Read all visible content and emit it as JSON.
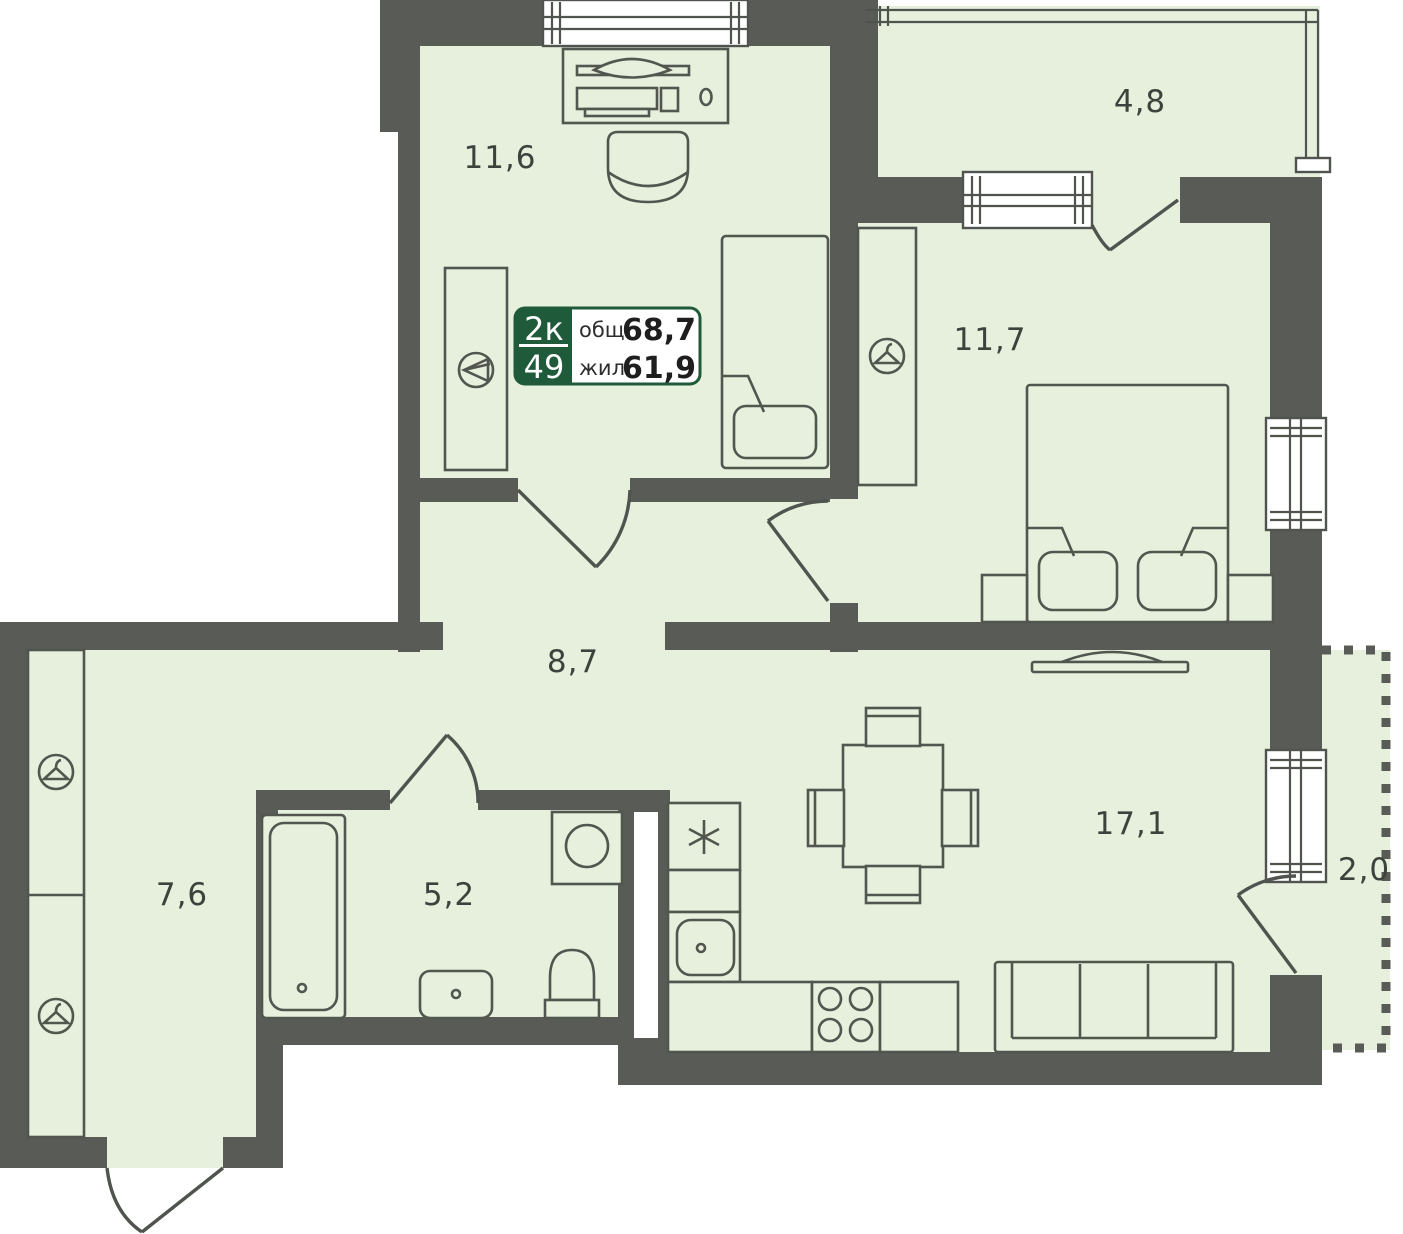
{
  "plate": {
    "type": "2к",
    "number": "49",
    "total_label": "общ.",
    "total_value": "68,7",
    "living_label": "жил.",
    "living_value": "61,9"
  },
  "rooms": {
    "study": {
      "area": "11,6"
    },
    "loggia": {
      "area": "4,8"
    },
    "bedroom": {
      "area": "11,7"
    },
    "hall": {
      "area": "8,7"
    },
    "corridor": {
      "area": "7,6"
    },
    "bathroom": {
      "area": "5,2"
    },
    "kitchen_living": {
      "area": "17,1"
    },
    "balcony": {
      "area": "2,0"
    }
  },
  "colors": {
    "wall": "#595b56",
    "floor": "#e6f0dd",
    "outline": "#51564f",
    "plate_green": "#1f5a3b",
    "label_text": "#3d433c",
    "background": "#ffffff"
  },
  "icons": {
    "hanger": "clothes-hanger",
    "wardrobe_side": "side-hanger-triangle",
    "fridge": "asterisk"
  }
}
